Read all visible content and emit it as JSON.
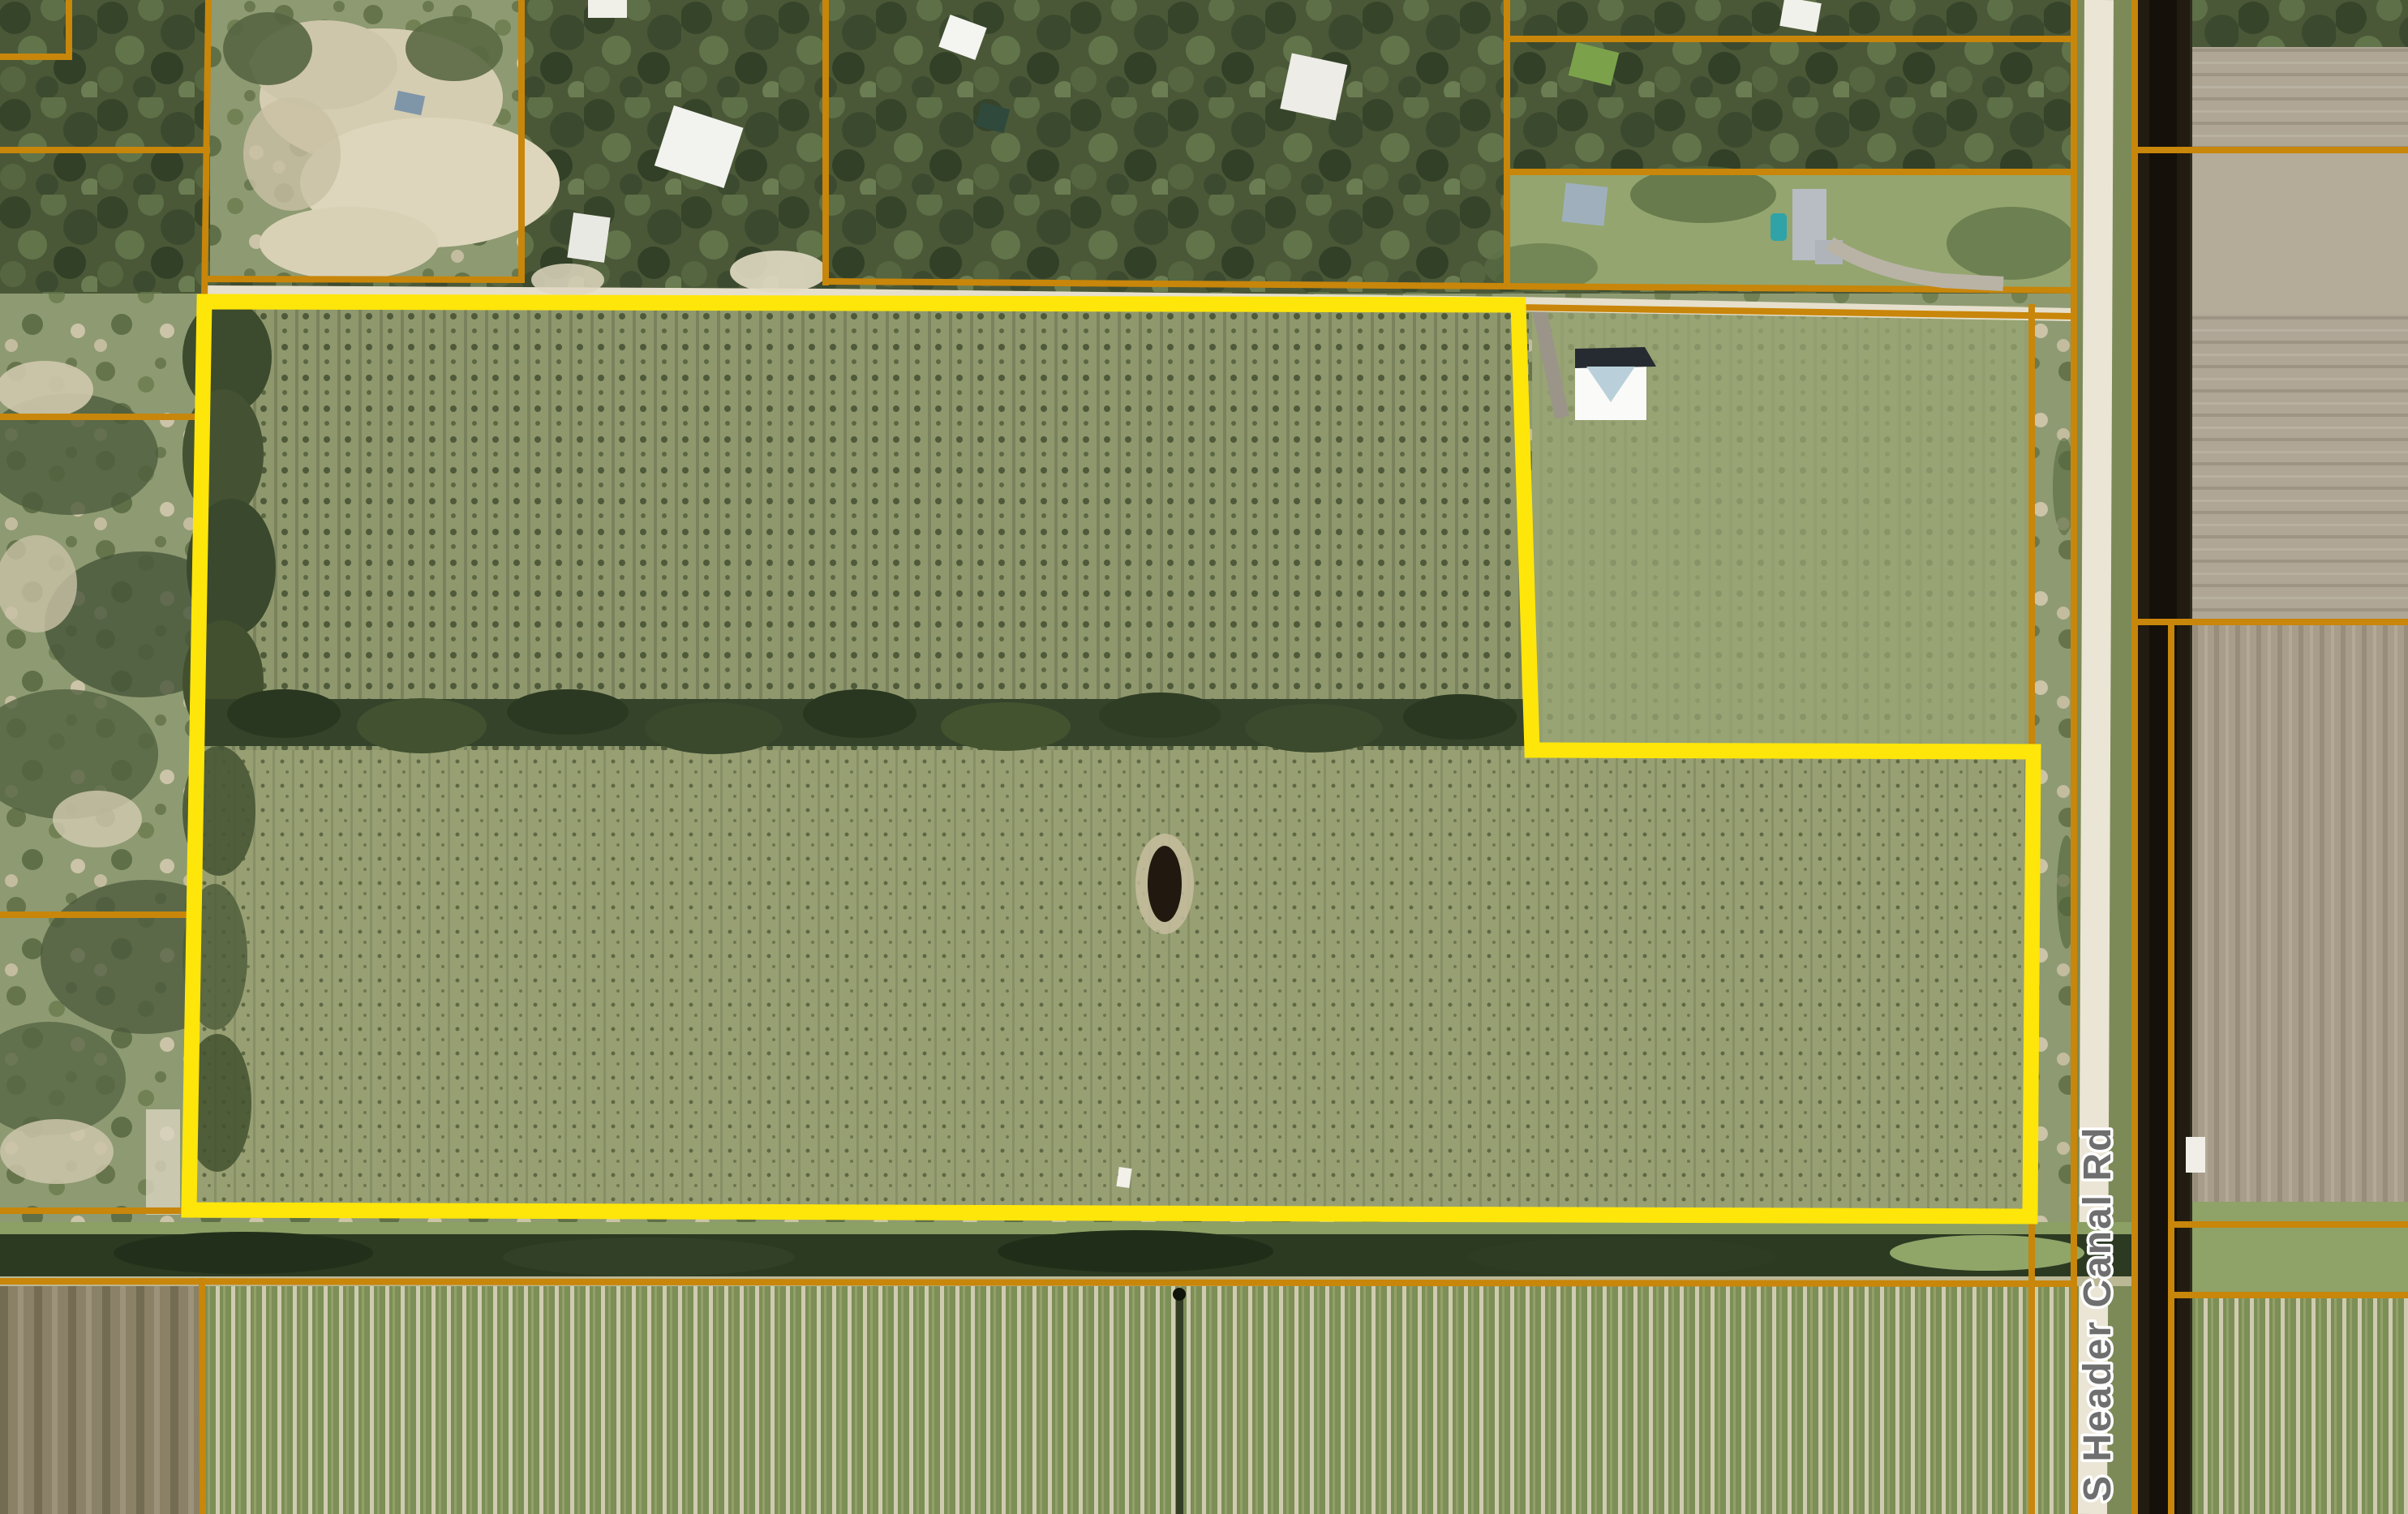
{
  "map": {
    "road_label": "S Header Canal Rd",
    "colors": {
      "parcel_line": "#C8860A",
      "highlight": "#FFE60A",
      "road_label_text": "#6F6F6F",
      "road_label_halo": "#FFFFFF",
      "canal_water": "#1C150C",
      "road_surface": "#EBE5D6"
    },
    "highlighted_parcel": {
      "outline_points": "252,372 1872,376 1889,925 2507,927 2503,1500 233,1492"
    }
  }
}
